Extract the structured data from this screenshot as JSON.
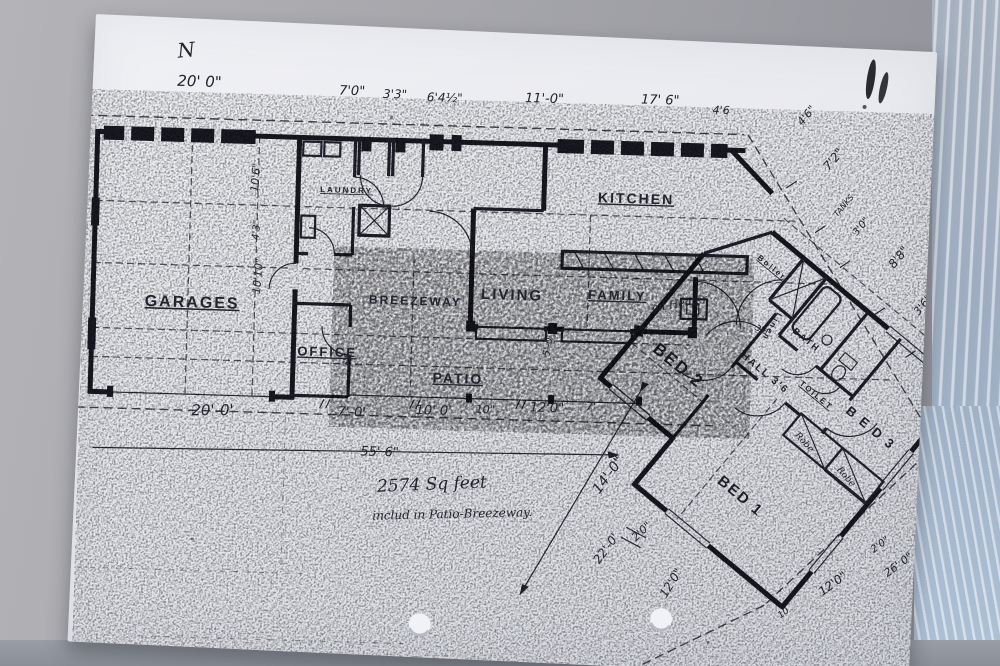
{
  "colors": {
    "ink": "#23232c",
    "paper": "#e8e9ee",
    "background": "#a3a4a9",
    "gloss_accent": "#a9bdd2"
  },
  "note": {
    "line1": "2574  Sq feet",
    "line2": "includ in Patio-Breezeway."
  },
  "north_mark": "N",
  "labels": [
    {
      "name": "north-mark",
      "frame": "paper",
      "cls": "hand",
      "text": "N",
      "x": 84,
      "y": 40,
      "size": 20,
      "rot": -8
    },
    {
      "name": "room-garage",
      "frame": "plan",
      "cls": "room u",
      "text": "GARAGES",
      "x": 62,
      "y": 285,
      "size": 16,
      "sp": 4
    },
    {
      "name": "room-office",
      "frame": "plan",
      "cls": "room u",
      "text": "OFFICE",
      "x": 216,
      "y": 330,
      "size": 13,
      "sp": 2
    },
    {
      "name": "room-laundry",
      "frame": "plan",
      "cls": "room u",
      "text": "LAUNDRY",
      "x": 234,
      "y": 166,
      "size": 8,
      "sp": 1
    },
    {
      "name": "room-breezeway",
      "frame": "plan",
      "cls": "room",
      "text": "BREEZEWAY",
      "x": 286,
      "y": 276,
      "size": 12,
      "sp": 1
    },
    {
      "name": "room-living",
      "frame": "plan",
      "cls": "room",
      "text": "LIVING",
      "x": 398,
      "y": 268,
      "size": 15,
      "sp": 3
    },
    {
      "name": "room-family",
      "frame": "plan",
      "cls": "room u",
      "text": "FAMILY",
      "x": 505,
      "y": 265,
      "size": 13,
      "sp": 2
    },
    {
      "name": "room-kitchen",
      "frame": "plan",
      "cls": "room u",
      "text": "KITCHEN",
      "x": 512,
      "y": 168,
      "size": 14,
      "sp": 3
    },
    {
      "name": "room-patio",
      "frame": "plan",
      "cls": "room u",
      "text": "PATIO",
      "x": 352,
      "y": 353,
      "size": 14,
      "sp": 3
    },
    {
      "name": "room-bed2",
      "frame": "wing",
      "cls": "room",
      "text": "BED 2",
      "x": 78,
      "y": 148,
      "size": 17,
      "sp": 3
    },
    {
      "name": "room-bed3",
      "frame": "wing",
      "cls": "room",
      "text": "B E D 3",
      "x": 266,
      "y": 72,
      "size": 13,
      "sp": 2
    },
    {
      "name": "room-bed1",
      "frame": "wing",
      "cls": "room",
      "text": "BED 1",
      "x": 212,
      "y": 208,
      "size": 15,
      "sp": 2
    },
    {
      "name": "room-hall",
      "frame": "wing",
      "cls": "room",
      "text": "HALL 3'6",
      "x": 150,
      "y": 96,
      "size": 10,
      "sp": 1
    },
    {
      "name": "room-toilet",
      "frame": "wing",
      "cls": "room u",
      "text": "TOILET",
      "x": 213,
      "y": 80,
      "size": 8,
      "sp": 1
    },
    {
      "name": "room-bath",
      "frame": "wing",
      "cls": "room",
      "text": "BATH",
      "x": 174,
      "y": 44,
      "size": 9,
      "sp": 1
    },
    {
      "name": "closet-boiler",
      "frame": "wing",
      "cls": "room u",
      "text": "Boiler",
      "x": 100,
      "y": 10,
      "size": 8
    },
    {
      "name": "closet-linen",
      "frame": "wing",
      "cls": "room",
      "text": "Linen",
      "x": 150,
      "y": 38,
      "size": 8,
      "rot": 80
    },
    {
      "name": "closet-robe-1",
      "frame": "wing",
      "cls": "hand",
      "text": "Robe",
      "x": 242,
      "y": 122,
      "size": 9,
      "rot": 8
    },
    {
      "name": "closet-robe-2",
      "frame": "wing",
      "cls": "hand",
      "text": "Robe",
      "x": 296,
      "y": 122,
      "size": 9,
      "rot": 8
    },
    {
      "name": "annot-oil-heater",
      "frame": "plan",
      "cls": "hand",
      "text": "oil Heater",
      "x": 570,
      "y": 276,
      "size": 11,
      "rot": -12
    },
    {
      "name": "annot-tanks",
      "frame": "plan",
      "cls": "dim",
      "text": "TANKS",
      "x": 752,
      "y": 176,
      "size": 8,
      "rot": -52
    },
    {
      "name": "note-line1",
      "frame": "plan",
      "cls": "hand",
      "text": "2574  Sq feet",
      "x": 300,
      "y": 464,
      "size": 17,
      "rot": -4
    },
    {
      "name": "note-line2",
      "frame": "plan",
      "cls": "hand",
      "text": "includ in Patio-Breezeway.",
      "x": 296,
      "y": 492,
      "size": 12,
      "rot": -3
    },
    {
      "name": "dim-top-1",
      "frame": "plan",
      "cls": "dim",
      "text": "20' 0\"",
      "x": 88,
      "y": 64,
      "size": 15
    },
    {
      "name": "dim-top-2",
      "frame": "plan",
      "cls": "dim",
      "text": "7'0\"",
      "x": 250,
      "y": 68,
      "size": 13
    },
    {
      "name": "dim-top-3",
      "frame": "plan",
      "cls": "dim",
      "text": "3'3\"",
      "x": 294,
      "y": 70,
      "size": 12
    },
    {
      "name": "dim-top-4",
      "frame": "plan",
      "cls": "dim",
      "text": "6'4½\"",
      "x": 338,
      "y": 72,
      "size": 12
    },
    {
      "name": "dim-top-5",
      "frame": "plan",
      "cls": "dim",
      "text": "11'-0\"",
      "x": 436,
      "y": 70,
      "size": 13
    },
    {
      "name": "dim-top-6",
      "frame": "plan",
      "cls": "dim",
      "text": "17' 6\"",
      "x": 552,
      "y": 68,
      "size": 13
    },
    {
      "name": "dim-top-7",
      "frame": "plan",
      "cls": "dim",
      "text": "4'6",
      "x": 624,
      "y": 76,
      "size": 11
    },
    {
      "name": "dim-bot-1",
      "frame": "plan",
      "cls": "dim",
      "text": "20'-0'",
      "x": 112,
      "y": 393,
      "size": 15,
      "rot": -2
    },
    {
      "name": "dim-bot-2",
      "frame": "plan",
      "cls": "dim",
      "text": "7'-0'",
      "x": 258,
      "y": 389,
      "size": 13
    },
    {
      "name": "dim-bot-3",
      "frame": "plan",
      "cls": "dim",
      "text": "10' 0'",
      "x": 336,
      "y": 385,
      "size": 13
    },
    {
      "name": "dim-bot-4",
      "frame": "plan",
      "cls": "dim",
      "text": "10\"",
      "x": 396,
      "y": 382,
      "size": 11
    },
    {
      "name": "dim-bot-5",
      "frame": "plan",
      "cls": "dim",
      "text": "12'0\"",
      "x": 450,
      "y": 379,
      "size": 13
    },
    {
      "name": "dim-bot-6",
      "frame": "plan",
      "cls": "dim",
      "text": "7'",
      "x": 506,
      "y": 376,
      "size": 11
    },
    {
      "name": "dim-overall",
      "frame": "plan",
      "cls": "dim",
      "text": "55' 6\"",
      "x": 282,
      "y": 428,
      "size": 13
    },
    {
      "name": "dim-col-1",
      "frame": "plan",
      "cls": "dim",
      "text": "10'6\"",
      "x": 172,
      "y": 168,
      "size": 11,
      "rot": -87
    },
    {
      "name": "dim-col-2",
      "frame": "plan",
      "cls": "dim",
      "text": "4'3\"",
      "x": 174,
      "y": 216,
      "size": 10,
      "rot": -87
    },
    {
      "name": "dim-col-3",
      "frame": "plan",
      "cls": "dim",
      "text": "10'10\"",
      "x": 177,
      "y": 270,
      "size": 11,
      "rot": -87
    },
    {
      "name": "dim-right-1",
      "frame": "plan",
      "cls": "dim",
      "text": "4'6\"",
      "x": 714,
      "y": 86,
      "size": 11,
      "rot": -52
    },
    {
      "name": "dim-right-2",
      "frame": "plan",
      "cls": "dim",
      "text": "7'2\"",
      "x": 742,
      "y": 130,
      "size": 12,
      "rot": -52
    },
    {
      "name": "dim-right-3",
      "frame": "plan",
      "cls": "dim",
      "text": "3'0\"",
      "x": 772,
      "y": 194,
      "size": 10,
      "rot": -52
    },
    {
      "name": "dim-right-4",
      "frame": "plan",
      "cls": "dim",
      "text": "8'8\"",
      "x": 810,
      "y": 226,
      "size": 12,
      "rot": -52
    },
    {
      "name": "dim-right-5",
      "frame": "plan",
      "cls": "dim",
      "text": "3'6\"",
      "x": 836,
      "y": 272,
      "size": 11,
      "rot": -52
    },
    {
      "name": "dim-diag-1",
      "frame": "plan",
      "cls": "dim",
      "text": "14'-0\"",
      "x": 522,
      "y": 460,
      "size": 14,
      "rot": -55
    },
    {
      "name": "dim-diag-2",
      "frame": "plan",
      "cls": "dim",
      "text": "2'0\"",
      "x": 560,
      "y": 506,
      "size": 11,
      "rot": -45
    },
    {
      "name": "dim-diag-3",
      "frame": "plan",
      "cls": "dim",
      "text": "22'-0'",
      "x": 524,
      "y": 530,
      "size": 12,
      "rot": -55
    },
    {
      "name": "dim-diag-4",
      "frame": "plan",
      "cls": "dim",
      "text": "12'0\"",
      "x": 592,
      "y": 562,
      "size": 12,
      "rot": -60
    },
    {
      "name": "dim-wing-1",
      "frame": "wing",
      "cls": "dim",
      "text": "12'0\"",
      "x": 366,
      "y": 228,
      "size": 12,
      "rot": -76
    },
    {
      "name": "dim-wing-2",
      "frame": "wing",
      "cls": "dim",
      "text": "2'0\"",
      "x": 378,
      "y": 162,
      "size": 10,
      "rot": -76
    },
    {
      "name": "dim-wing-3",
      "frame": "wing",
      "cls": "dim",
      "text": "26' 0\"",
      "x": 404,
      "y": 172,
      "size": 11,
      "rot": -76
    },
    {
      "name": "dim-wing-4",
      "frame": "wing",
      "cls": "dim",
      "text": "10' 0\"",
      "x": 396,
      "y": 96,
      "size": 12,
      "rot": -76
    },
    {
      "name": "dim-wing-5",
      "frame": "wing",
      "cls": "dim",
      "text": "10",
      "x": 348,
      "y": 272,
      "size": 9,
      "rot": -76
    },
    {
      "name": "dim-small-1",
      "frame": "plan",
      "cls": "dim",
      "text": "5'-0'",
      "x": 468,
      "y": 324,
      "size": 10,
      "rot": -82
    },
    {
      "name": "dim-small-2",
      "frame": "plan",
      "cls": "dim",
      "text": "3'6",
      "x": 268,
      "y": 340,
      "size": 9,
      "rot": -85
    },
    {
      "name": "dim-small-3",
      "frame": "wing",
      "cls": "dim",
      "text": "3'6\"",
      "x": 144,
      "y": 66,
      "size": 8,
      "rot": -15
    }
  ]
}
